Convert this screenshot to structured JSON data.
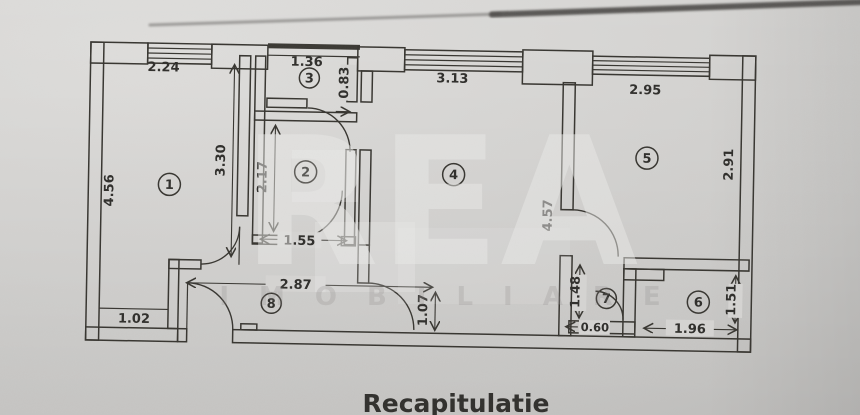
{
  "photo": {
    "footer_title": "Recapitulatie",
    "watermark": {
      "primary": "REA",
      "secondary": "IMOBILIARE"
    }
  },
  "colors": {
    "paper": "#d5d4d2",
    "ink": "#36342f",
    "watermark_light": "#eaeae8"
  },
  "rooms": [
    {
      "number": "1"
    },
    {
      "number": "2"
    },
    {
      "number": "3"
    },
    {
      "number": "4"
    },
    {
      "number": "5"
    },
    {
      "number": "6"
    },
    {
      "number": "7"
    },
    {
      "number": "8"
    }
  ],
  "dimensions": {
    "room1_window": "2.24",
    "room1_side": "4.56",
    "room1_inner": "3.30",
    "room1_bottom": "1.02",
    "room2_height": "2.17",
    "room2_door": "1.55",
    "room3_width": "1.36",
    "room3_passage": "0.83",
    "room4_window": "3.13",
    "room4_height": "4.57",
    "room5_window": "2.95",
    "room5_height": "2.91",
    "room6_width": "1.96",
    "room6_height": "1.51",
    "wc_height": "1.48",
    "wc_door": "0.60",
    "hall_width": "2.87",
    "hall_height": "1.07"
  }
}
